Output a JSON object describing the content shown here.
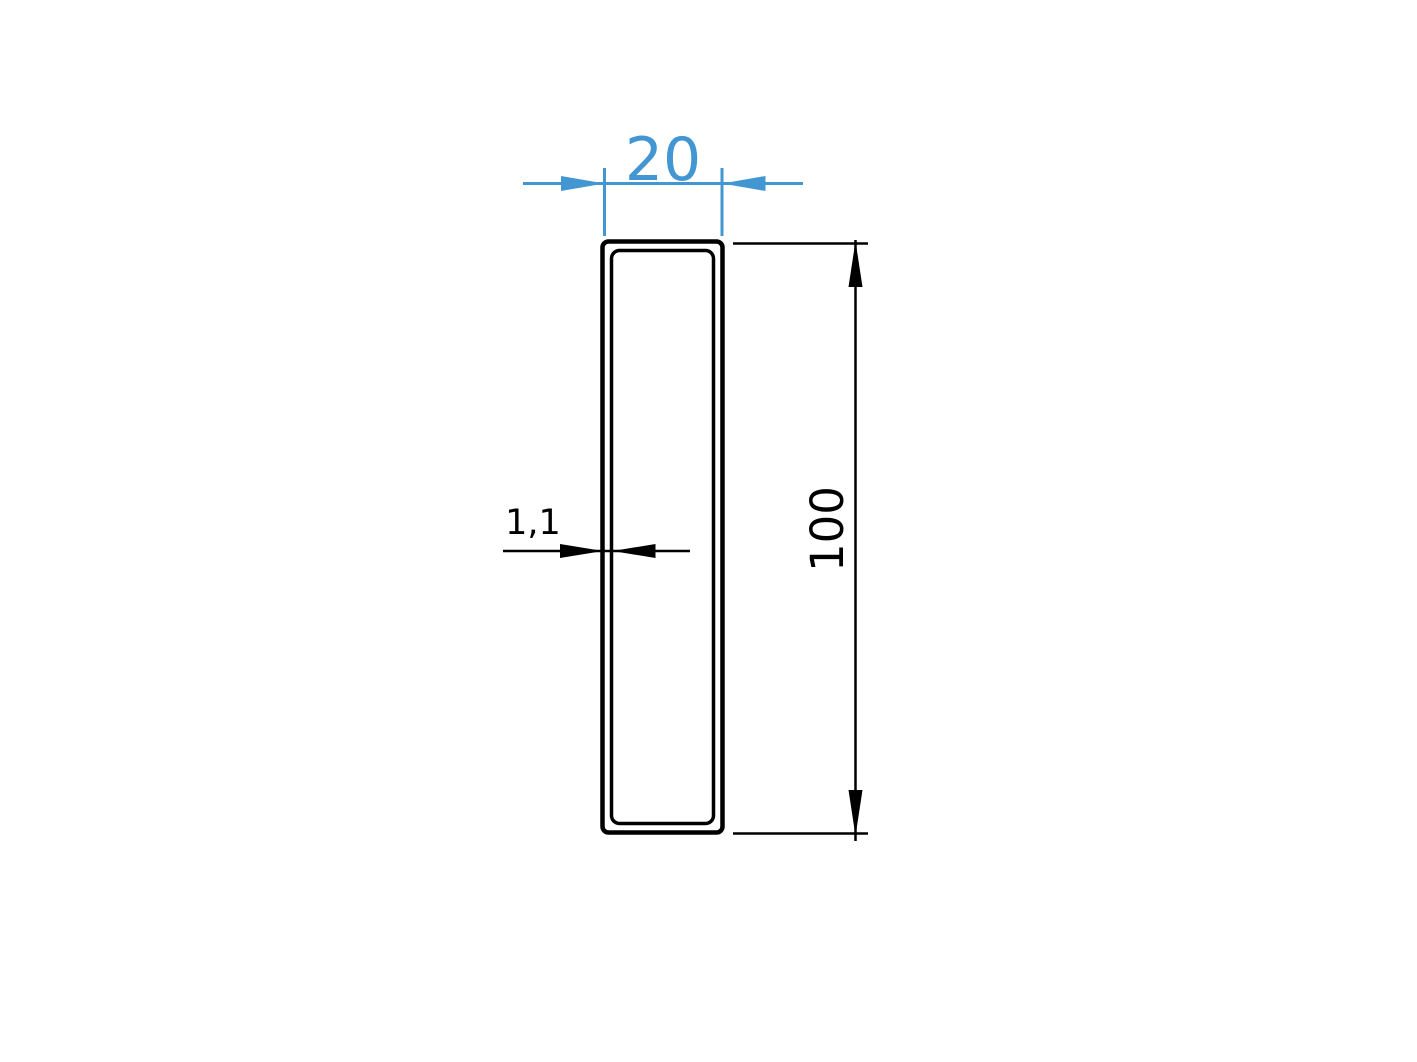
{
  "colors": {
    "accent": "#4297d3",
    "ink": "#000000",
    "canvas": "#ffffff"
  },
  "drawing": {
    "profile": {
      "shape": "rectangular-tube-cross-section"
    },
    "dimensions": {
      "width": {
        "value": "20"
      },
      "height": {
        "value": "100"
      },
      "thickness": {
        "value": "1,1"
      }
    }
  }
}
